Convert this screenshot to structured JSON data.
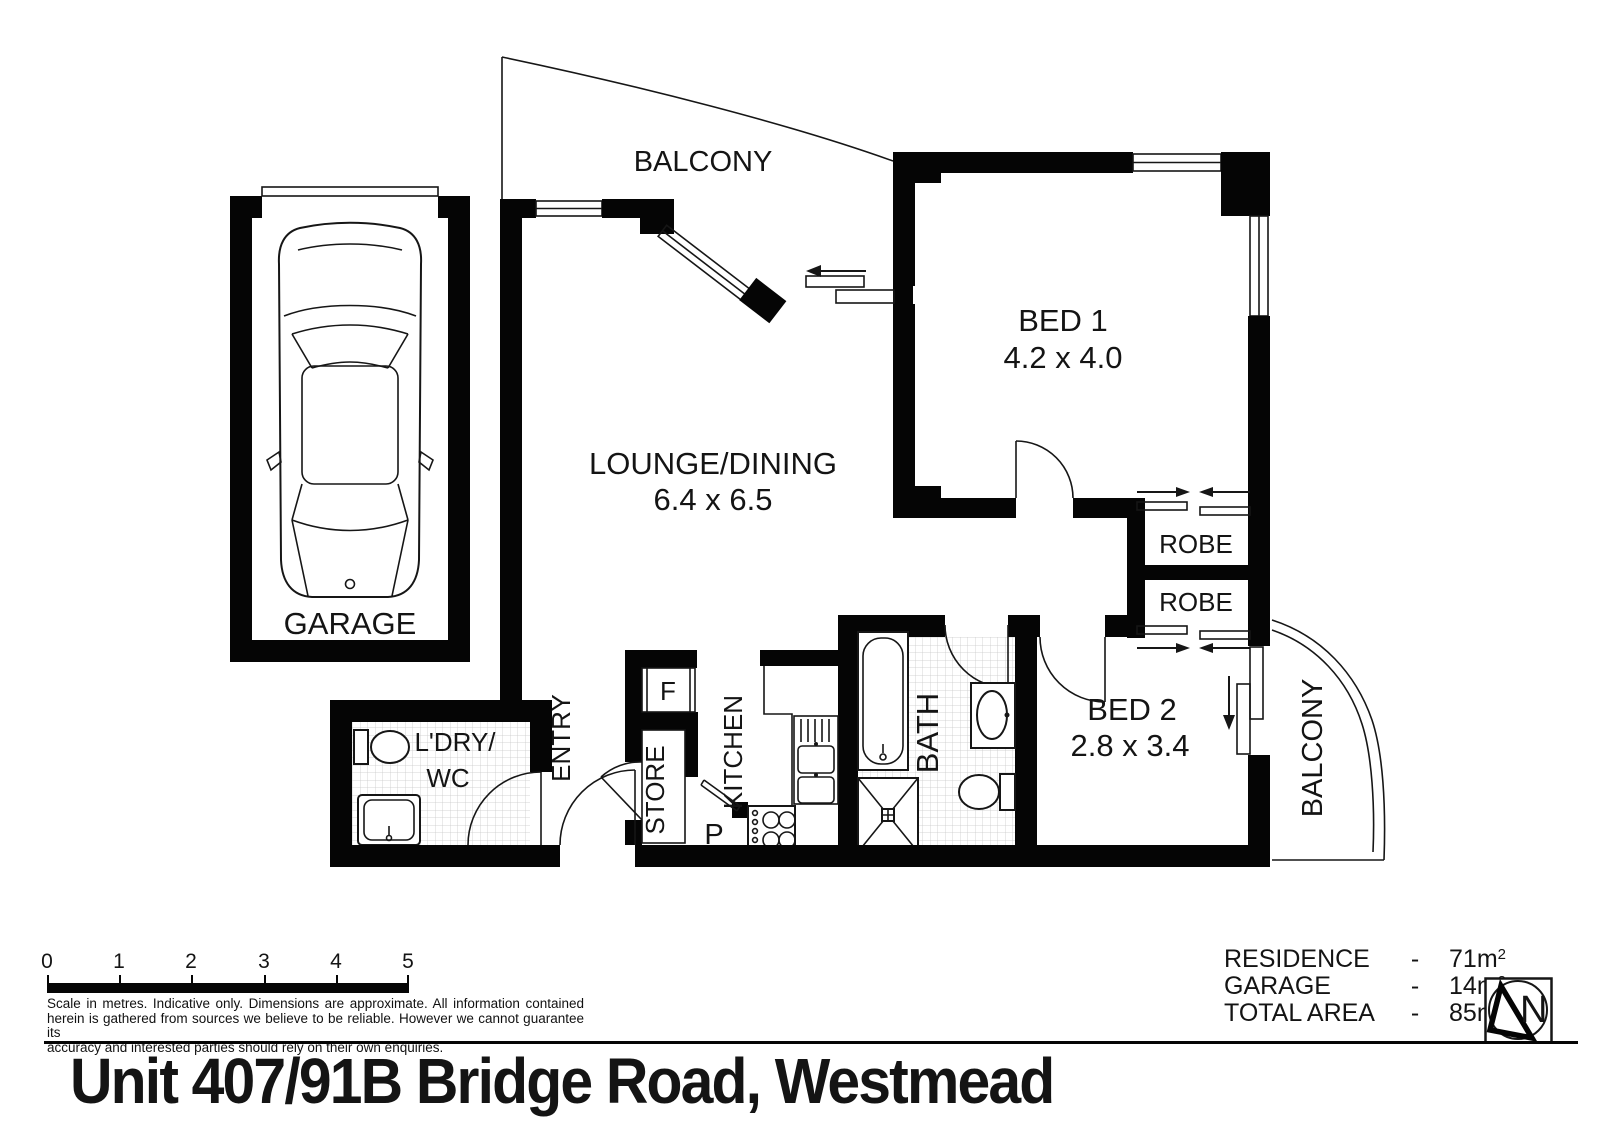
{
  "title": "Unit 407/91B Bridge Road, Westmead",
  "north_label": "N",
  "rooms": {
    "balcony_top": "BALCONY",
    "garage": "GARAGE",
    "lounge": {
      "name": "LOUNGE/DINING",
      "dims": "6.4 x 6.5"
    },
    "bed1": {
      "name": "BED 1",
      "dims": "4.2 x 4.0"
    },
    "bed2": {
      "name": "BED 2",
      "dims": "2.8 x 3.4"
    },
    "robe1": "ROBE",
    "robe2": "ROBE",
    "balcony_right": "BALCONY",
    "bath": "BATH",
    "kitchen": "KITCHEN",
    "fridge": "F",
    "store": "STORE",
    "pantry": "P",
    "entry": "ENTRY",
    "laundry_line1": "L'DRY/",
    "laundry_line2": "WC"
  },
  "scale_bar": {
    "ticks": [
      "0",
      "1",
      "2",
      "3",
      "4",
      "5"
    ]
  },
  "disclaimer": {
    "lines": [
      "Scale in metres. Indicative only. Dimensions are approximate. All information contained",
      "herein is gathered from sources we believe to be reliable. However we cannot guarantee its",
      "accuracy and interested parties should rely on their own enquiries."
    ]
  },
  "legend": {
    "rows": [
      {
        "label": "RESIDENCE",
        "sep": "-",
        "value": "71m",
        "sup": "2"
      },
      {
        "label": "GARAGE",
        "sep": "-",
        "value": "14m",
        "sup": "2"
      },
      {
        "label": "TOTAL AREA",
        "sep": "-",
        "value": "85m",
        "sup": "2"
      }
    ]
  },
  "colors": {
    "wall": "#050505",
    "line": "#161616",
    "tile": "#c9c9c9"
  }
}
